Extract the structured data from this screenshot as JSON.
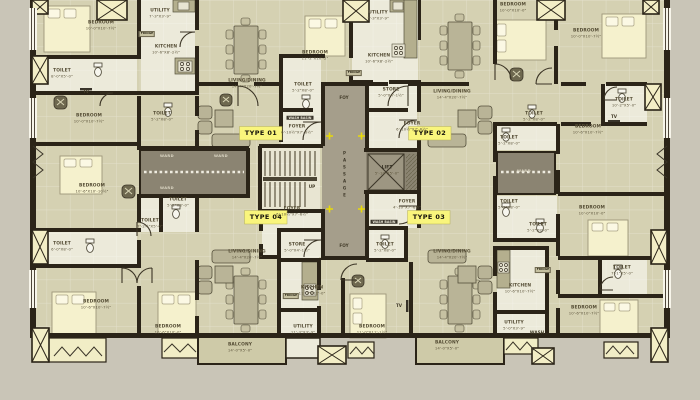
{
  "drawing": {
    "kind": "apartment-floor-plan"
  },
  "colors": {
    "background": "#c9c5b7",
    "floor": "#d5d1b2",
    "floor_light": "#eceada",
    "floor_pale": "#f1edc6",
    "balcony": "#cecaa8",
    "wall": "#2b2418",
    "core_gray": "#a59e8b",
    "ward_gray": "#8b8472",
    "highlight": "#f9f57c",
    "accent_dot": "#e8d90a"
  },
  "unit_labels": [
    {
      "label": "TYPE 01",
      "x": 261,
      "y": 133
    },
    {
      "label": "TYPE 02",
      "x": 430,
      "y": 133
    },
    {
      "label": "TYPE 04",
      "x": 266,
      "y": 217
    },
    {
      "label": "TYPE 03",
      "x": 429,
      "y": 217
    }
  ],
  "rooms": [
    {
      "label": "BEDROOM",
      "dims": "10'-0\"X10'-7½\"",
      "x": 101,
      "y": 26
    },
    {
      "label": "TOILET",
      "dims": "8'-0\"X5'-0\"",
      "x": 62,
      "y": 74
    },
    {
      "label": "KITCHEN",
      "dims": "10'-6\"X8'-2½\"",
      "x": 166,
      "y": 50
    },
    {
      "label": "UTILITY",
      "dims": "7'-3\"X3'-9\"",
      "x": 160,
      "y": 14
    },
    {
      "label": "LIVING/DINING",
      "dims": "14'-4\"X20'-7½\"",
      "x": 247,
      "y": 84
    },
    {
      "label": "BEDROOM",
      "dims": "10'-0\"X10'-7½\"",
      "x": 89,
      "y": 119
    },
    {
      "label": "TOILET",
      "dims": "5'-2\"X8'-0\"",
      "x": 162,
      "y": 117
    },
    {
      "label": "TOILET",
      "dims": "5'-2\"X8'-0\"",
      "x": 303,
      "y": 88
    },
    {
      "label": "FOYER",
      "dims": "6'-10½\"X7'-6½\"",
      "x": 297,
      "y": 130
    },
    {
      "label": "STORE",
      "dims": "5'-0\"X4'-1½\"",
      "x": 391,
      "y": 93
    },
    {
      "label": "BEDROOM",
      "dims": "11'-2\"X10'-2\"",
      "x": 315,
      "y": 56
    },
    {
      "label": "UTILITY",
      "dims": "7'-3\"X3'-9\"",
      "x": 378,
      "y": 16
    },
    {
      "label": "KITCHEN",
      "dims": "10'-6\"X8'-2½\"",
      "x": 379,
      "y": 59
    },
    {
      "label": "FOYER",
      "dims": "6'-10½\"X7'-6½\"",
      "x": 412,
      "y": 127
    },
    {
      "label": "LIVING/DINING",
      "dims": "14'-4\"X20'-7½\"",
      "x": 452,
      "y": 95
    },
    {
      "label": "BEDROOM",
      "dims": "10'-0\"X10'-0\"",
      "x": 513,
      "y": 8
    },
    {
      "label": "BEDROOM",
      "dims": "10'-0\"X10'-7½\"",
      "x": 586,
      "y": 34
    },
    {
      "label": "TOILET",
      "dims": "10'-2\"X5'-0\"",
      "x": 624,
      "y": 103
    },
    {
      "label": "BEDROOM",
      "dims": "10'-6\"X10'-7½\"",
      "x": 588,
      "y": 130
    },
    {
      "label": "TOILET",
      "dims": "5'-2\"X8'-0\"",
      "x": 534,
      "y": 117
    },
    {
      "label": "BEDROOM",
      "dims": "10'-6\"X10'-10½\"",
      "x": 92,
      "y": 189
    },
    {
      "label": "TOILET",
      "dims": "5'-2\"X8'-0\"",
      "x": 178,
      "y": 203
    },
    {
      "label": "TOILET",
      "dims": "7'-2½\"X5'-0\"",
      "x": 150,
      "y": 224
    },
    {
      "label": "TOILET",
      "dims": "6'-0\"X8'-0\"",
      "x": 62,
      "y": 247
    },
    {
      "label": "BEDROOM",
      "dims": "10'-0\"X10'-0\"",
      "x": 592,
      "y": 211
    },
    {
      "label": "TOILET",
      "dims": "5'-2\"X8'-0\"",
      "x": 509,
      "y": 141
    },
    {
      "label": "TOILET",
      "dims": "5'-2\"X8'-0\"",
      "x": 509,
      "y": 205
    },
    {
      "label": "TOILET",
      "dims": "5'-2\"X8'-0\"",
      "x": 538,
      "y": 228
    },
    {
      "label": "FOYER",
      "dims": "6'-10½\"X7'-6½\"",
      "x": 292,
      "y": 212
    },
    {
      "label": "FOYER",
      "dims": "4'-10\"X7'-6½\"",
      "x": 407,
      "y": 205
    },
    {
      "label": "STORE",
      "dims": "5'-0\"X4'-1½\"",
      "x": 297,
      "y": 248
    },
    {
      "label": "TOILET",
      "dims": "5'-2\"X8'-0\"",
      "x": 385,
      "y": 248
    },
    {
      "label": "LIVING/DINING",
      "dims": "14'-4\"X20'-7½\"",
      "x": 247,
      "y": 255
    },
    {
      "label": "KITCHEN",
      "dims": "11'-3\"X10'-0\"",
      "x": 312,
      "y": 291
    },
    {
      "label": "UTILITY",
      "dims": "11'-3\"X3'-9\"",
      "x": 303,
      "y": 330
    },
    {
      "label": "BEDROOM",
      "dims": "11'-0\"X11'-1½\"",
      "x": 372,
      "y": 330
    },
    {
      "label": "BALCONY",
      "dims": "14'-0\"X5'-0\"",
      "x": 240,
      "y": 348
    },
    {
      "label": "BEDROOM",
      "dims": "10'-6\"X10'-7½\"",
      "x": 96,
      "y": 305
    },
    {
      "label": "BEDROOM",
      "dims": "10'-6\"X10'-0\"",
      "x": 168,
      "y": 330
    },
    {
      "label": "LIVING/DINING",
      "dims": "14'-4\"X20'-7½\"",
      "x": 452,
      "y": 255
    },
    {
      "label": "KITCHEN",
      "dims": "10'-6\"X10'-7½\"",
      "x": 520,
      "y": 289
    },
    {
      "label": "UTILITY",
      "dims": "5'-0\"X3'-9\"",
      "x": 514,
      "y": 326
    },
    {
      "label": "BEDROOM",
      "dims": "10'-6\"X10'-7½\"",
      "x": 584,
      "y": 311
    },
    {
      "label": "TOILET",
      "dims": "7'-1\"X5'-0\"",
      "x": 622,
      "y": 271
    },
    {
      "label": "BALCONY",
      "dims": "14'-0\"X5'-0\"",
      "x": 447,
      "y": 346
    },
    {
      "label": "LIFT",
      "dims": "5'-10\"X5'-0\"",
      "x": 387,
      "y": 171
    }
  ],
  "small_labels": [
    {
      "label": "UP",
      "x": 312,
      "y": 187
    },
    {
      "label": "FOY",
      "x": 344,
      "y": 98
    },
    {
      "label": "FOY",
      "x": 344,
      "y": 246
    },
    {
      "label": "WASH",
      "x": 537,
      "y": 333
    },
    {
      "label": "TV",
      "x": 86,
      "y": 92
    },
    {
      "label": "TV",
      "x": 614,
      "y": 117
    },
    {
      "label": "TV",
      "x": 399,
      "y": 306
    }
  ],
  "strips": [
    {
      "label": "WASH BASIN",
      "x": 300,
      "y": 118
    },
    {
      "label": "WASH BASIN",
      "x": 384,
      "y": 222
    }
  ],
  "wards": [
    {
      "label": "WARD",
      "x": 167,
      "y": 157
    },
    {
      "label": "WARD",
      "x": 167,
      "y": 189
    },
    {
      "label": "WARD",
      "x": 221,
      "y": 157
    },
    {
      "label": "WARD",
      "x": 524,
      "y": 172
    }
  ],
  "fridges": [
    {
      "label": "FRIDGE",
      "x": 147,
      "y": 34
    },
    {
      "label": "FRIDGE",
      "x": 354,
      "y": 73
    },
    {
      "label": "FRIDGE",
      "x": 291,
      "y": 296
    },
    {
      "label": "FRIDGE",
      "x": 543,
      "y": 270
    }
  ],
  "passage": {
    "label": "PASSAGE",
    "x": 344,
    "y": 175
  }
}
